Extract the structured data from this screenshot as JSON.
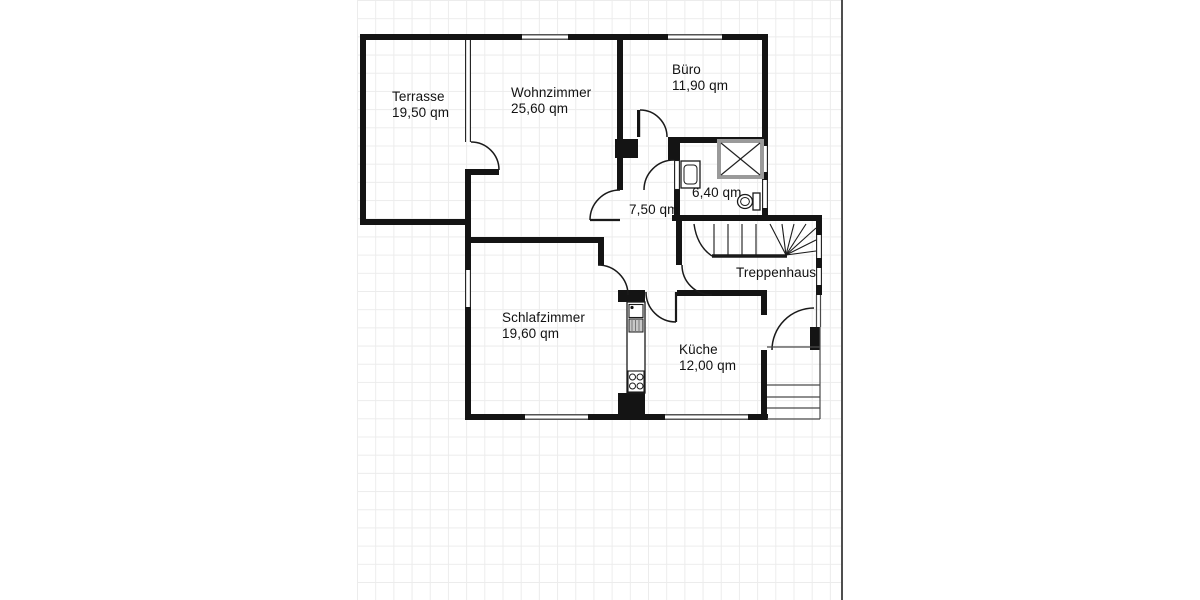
{
  "page": {
    "background_color": "#ffffff",
    "grid_line_color": "#ececec",
    "wall_color": "#141414",
    "sheet_border_color": "#4f4f4f"
  },
  "floorplan": {
    "unit_suffix": "qm",
    "rooms": [
      {
        "id": "terrasse",
        "name": "Terrasse",
        "area": "19,50 qm"
      },
      {
        "id": "wohnzimmer",
        "name": "Wohnzimmer",
        "area": "25,60 qm"
      },
      {
        "id": "buero",
        "name": "Büro",
        "area": "11,90 qm"
      },
      {
        "id": "flur",
        "name": "",
        "area": "7,50 qm"
      },
      {
        "id": "bad",
        "name": "",
        "area": "6,40 qm"
      },
      {
        "id": "treppenhaus",
        "name": "Treppenhaus",
        "area": ""
      },
      {
        "id": "schlafzimmer",
        "name": "Schlafzimmer",
        "area": "19,60 qm"
      },
      {
        "id": "kueche",
        "name": "Küche",
        "area": "12,00 qm"
      }
    ]
  }
}
